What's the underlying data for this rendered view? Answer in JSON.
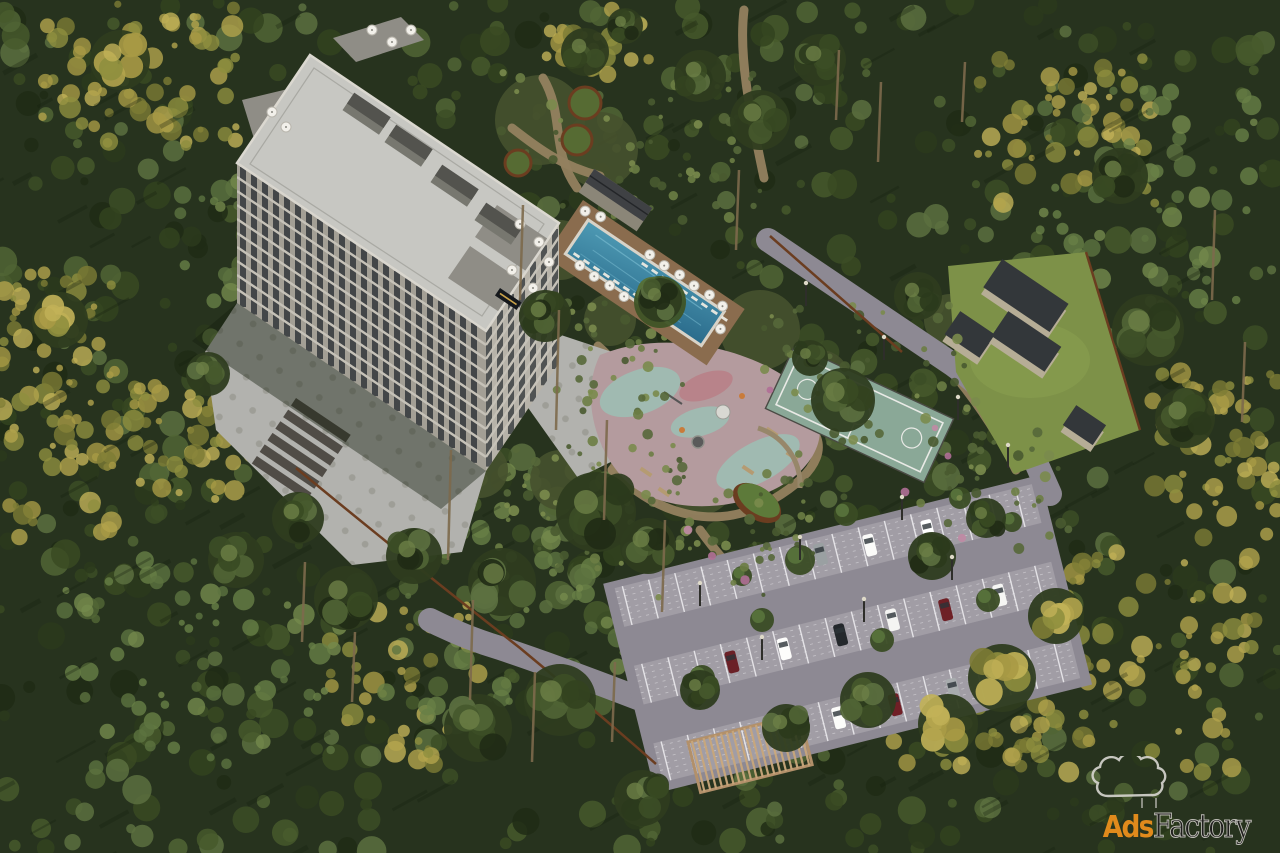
{
  "description": "Aerial 3D render of a high-rise residential complex set in a dense pine forest, with a rooftop-terraced tower, outdoor swimming pool with sun loungers and umbrellas, landscaped gardens with winding paths, a children's playground, a fenced basketball court, a lawn with utility buildings, and a large striped parking lot with cars and a pergola.",
  "watermark": {
    "brand_ads": "Ads",
    "brand_factory": "Factory",
    "icon": "smoke-cloud-icon",
    "color_ads": "#e08a1c",
    "color_factory": "#1f1f1d",
    "color_outline": "#d8d6d0"
  },
  "colors": {
    "forest_base": "#27331e",
    "shadow": "#16200f",
    "plaza": "#b2b2ae",
    "plaza_dot": "#96968f",
    "path": "#93815f",
    "road": "#8d8993",
    "parking_stall": "#a19da5",
    "parking_stripe": "#f0eff2",
    "deck": "#8a6c4e",
    "pool": "#3c86a4",
    "pool_deep": "#2b6c8c",
    "coping": "#d8d3c8",
    "court": "#8aa897",
    "court_line": "#e9eae6",
    "lawn": "#7d9148",
    "rubber_base": "#b49b9e",
    "rubber_teal": "#9cc0b4",
    "rubber_pink": "#b97f86",
    "roof": "#c7c7c2",
    "roof_edge": "#dbd8d0",
    "facade_sw": "#a39f95",
    "facade_se": "#b7b3a9",
    "window": "#363b3e",
    "floor_band": "#c6c2b8",
    "terrace": "#8f8d86",
    "corten": "#6b3d20",
    "box_wall": "#b6ad96",
    "box_top": "#33373a",
    "cabana_roof": "#3f4144",
    "umbrella": "#f2f0ea",
    "green_roof": "#5d7a3a",
    "pergola": "#c9a77b",
    "step": "#504c46",
    "garden_bed": "#46512d",
    "trunk": "#7d6a4c"
  },
  "scene": {
    "forest": {
      "count": 800,
      "palette": [
        "#33431f",
        "#3c4e26",
        "#2b3a1c",
        "#46592c",
        "#516535",
        "#5c7040",
        "#202b15",
        "#394a22"
      ],
      "autumn_palette": [
        "#8f8f3e",
        "#a89a45",
        "#b3a44c",
        "#7d7c35",
        "#c2b258"
      ],
      "light_palette": [
        "#5d7340",
        "#687f46",
        "#74894c"
      ],
      "autumn_regions": [
        [
          40,
          0,
          200,
          150,
          70
        ],
        [
          0,
          270,
          115,
          280,
          80
        ],
        [
          130,
          380,
          130,
          120,
          45
        ],
        [
          975,
          55,
          180,
          150,
          55
        ],
        [
          890,
          545,
          365,
          235,
          150
        ],
        [
          1150,
          365,
          130,
          175,
          55
        ],
        [
          330,
          600,
          150,
          170,
          45
        ],
        [
          545,
          0,
          110,
          75,
          22
        ]
      ],
      "light_regions": [
        [
          380,
          470,
          280,
          250,
          80
        ],
        [
          60,
          560,
          280,
          210,
          60
        ],
        [
          1040,
          90,
          220,
          230,
          55
        ],
        [
          180,
          140,
          220,
          220,
          50
        ]
      ],
      "streaks": 150
    },
    "trunks": [
      [
        448,
        560,
        110
      ],
      [
        520,
        300,
        95
      ],
      [
        556,
        430,
        120
      ],
      [
        604,
        520,
        100
      ],
      [
        662,
        612,
        92
      ],
      [
        470,
        700,
        100
      ],
      [
        532,
        762,
        90
      ],
      [
        612,
        742,
        80
      ],
      [
        836,
        120,
        70
      ],
      [
        878,
        162,
        80
      ],
      [
        962,
        122,
        60
      ],
      [
        1212,
        300,
        90
      ],
      [
        1242,
        422,
        80
      ],
      [
        302,
        642,
        80
      ],
      [
        352,
        702,
        70
      ],
      [
        736,
        250,
        80
      ]
    ],
    "clusters": [
      [
        585,
        52,
        24,
        "g"
      ],
      [
        625,
        26,
        18,
        "g"
      ],
      [
        700,
        76,
        26,
        "g"
      ],
      [
        760,
        120,
        30,
        "g"
      ],
      [
        820,
        60,
        26,
        "g"
      ],
      [
        545,
        316,
        26,
        "g"
      ],
      [
        596,
        512,
        40,
        "g"
      ],
      [
        648,
        546,
        28,
        "g"
      ],
      [
        502,
        582,
        34,
        "g"
      ],
      [
        660,
        300,
        22,
        "g"
      ],
      [
        843,
        400,
        32,
        "g"
      ],
      [
        810,
        358,
        18,
        "g"
      ],
      [
        918,
        296,
        24,
        "g"
      ],
      [
        1148,
        330,
        36,
        "g"
      ],
      [
        1185,
        418,
        30,
        "g"
      ],
      [
        1120,
        176,
        28,
        "g"
      ],
      [
        986,
        518,
        20,
        "g"
      ],
      [
        932,
        556,
        24,
        "g"
      ],
      [
        1056,
        616,
        28,
        "a"
      ],
      [
        1002,
        678,
        34,
        "a"
      ],
      [
        948,
        724,
        30,
        "a"
      ],
      [
        868,
        700,
        28,
        "g"
      ],
      [
        786,
        728,
        24,
        "g"
      ],
      [
        700,
        690,
        20,
        "g"
      ],
      [
        642,
        798,
        28,
        "g"
      ],
      [
        560,
        700,
        36,
        "g"
      ],
      [
        478,
        728,
        34,
        "g"
      ],
      [
        414,
        556,
        28,
        "g"
      ],
      [
        346,
        598,
        32,
        "g"
      ],
      [
        298,
        518,
        26,
        "g"
      ],
      [
        236,
        560,
        28,
        "g"
      ],
      [
        208,
        374,
        22,
        "g"
      ],
      [
        120,
        60,
        30,
        "a"
      ],
      [
        60,
        320,
        28,
        "a"
      ]
    ],
    "garden_beds": [
      [
        540,
        120,
        45
      ],
      [
        600,
        150,
        38
      ],
      [
        560,
        250,
        30
      ],
      [
        520,
        320,
        28
      ],
      [
        610,
        320,
        26
      ],
      [
        760,
        330,
        40
      ],
      [
        820,
        380,
        30
      ],
      [
        700,
        480,
        35
      ],
      [
        560,
        480,
        30
      ],
      [
        480,
        470,
        28
      ],
      [
        950,
        320,
        26
      ],
      [
        900,
        430,
        24
      ]
    ],
    "speckles": [
      [
        500,
        60,
        260,
        160,
        60
      ],
      [
        555,
        295,
        130,
        130,
        40
      ],
      [
        480,
        430,
        210,
        150,
        50
      ],
      [
        755,
        295,
        230,
        210,
        60
      ],
      [
        615,
        468,
        230,
        130,
        45
      ],
      [
        930,
        430,
        140,
        120,
        30
      ]
    ],
    "flowers": [
      [
        770,
        390
      ],
      [
        935,
        428
      ],
      [
        948,
        456
      ],
      [
        905,
        492
      ],
      [
        712,
        556
      ],
      [
        745,
        580
      ],
      [
        688,
        530
      ],
      [
        962,
        538
      ]
    ],
    "paths": [
      "M543,78 C565,115 550,150 577,188",
      "M512,128 C540,150 562,166 600,176",
      "M598,346 C640,382 642,430 612,470",
      "M612,470 C662,520 722,530 772,500",
      "M772,500 C820,472 832,442 802,420",
      "M700,530 C720,558 742,580 762,602",
      "M952,372 Q992,420 1016,470",
      "M744,10 C738,60 752,120 764,178"
    ],
    "roads": [
      "M768,240 L952,364 Q1002,400 1034,458 L1050,494",
      "M648,702 Q560,668 500,648 Q466,638 430,620"
    ],
    "fences": [
      "M770,236 L902,352",
      "M296,468 Q420,570 520,648 Q590,706 656,764",
      "M1086,252 L1140,430"
    ],
    "steps": {
      "x": 296,
      "y": 398,
      "count": 6,
      "w": 66,
      "h": 9,
      "gap": 14
    },
    "planters": [
      [
        585,
        103,
        16
      ],
      [
        577,
        140,
        15
      ],
      [
        518,
        163,
        13
      ]
    ],
    "roof_umbrellas": [
      [
        372,
        30
      ],
      [
        392,
        42
      ],
      [
        411,
        30
      ],
      [
        272,
        112
      ],
      [
        286,
        127
      ],
      [
        520,
        224
      ],
      [
        539,
        242
      ],
      [
        512,
        270
      ],
      [
        533,
        288
      ],
      [
        549,
        262
      ]
    ],
    "roof_boxes": [
      [
        352,
        96
      ],
      [
        394,
        128
      ],
      [
        440,
        168
      ],
      [
        484,
        206
      ]
    ],
    "pool": {
      "umbrellas": [
        [
          86,
          8
        ],
        [
          104,
          9
        ],
        [
          122,
          8
        ],
        [
          140,
          9
        ],
        [
          158,
          8
        ],
        [
          175,
          10
        ],
        [
          24,
          4
        ],
        [
          8,
          8
        ],
        [
          34,
          56
        ],
        [
          52,
          57
        ],
        [
          70,
          56
        ],
        [
          88,
          57
        ],
        [
          186,
          30
        ]
      ],
      "lounger_rows": [
        [
          18,
          84,
          180,
          12
        ],
        [
          48,
          22,
          94,
          12
        ]
      ]
    },
    "playground": {
      "teal_patches": [
        [
          640,
          392,
          42,
          22,
          -20
        ],
        [
          758,
          462,
          46,
          20,
          -28
        ],
        [
          700,
          422,
          30,
          14,
          -15
        ]
      ],
      "pink_patches": [
        [
          706,
          386,
          28,
          13,
          -20
        ]
      ],
      "benches": [
        [
          772,
          432
        ],
        [
          792,
          456
        ],
        [
          748,
          470
        ],
        [
          646,
          472
        ],
        [
          664,
          492
        ]
      ]
    },
    "lawn_structures": [
      [
        1000,
        266,
        80,
        34
      ],
      [
        958,
        318,
        42,
        28
      ],
      [
        1006,
        318,
        64,
        30
      ],
      [
        1074,
        412,
        36,
        24
      ]
    ],
    "parking": {
      "rows_y": [
        -105,
        -25,
        55
      ],
      "row_h": 40,
      "length": 430,
      "cars": [
        [
          258,
          -85,
          "#fbfbf9"
        ],
        [
          318,
          -85,
          "#ffffff"
        ],
        [
          208,
          -88,
          "#9aa0a2"
        ],
        [
          368,
          -86,
          "#1d4763"
        ],
        [
          96,
          -5,
          "#6b2027"
        ],
        [
          150,
          -5,
          "#fdfdfb"
        ],
        [
          208,
          -5,
          "#24282c"
        ],
        [
          262,
          -7,
          "#f4f4f2"
        ],
        [
          316,
          -4,
          "#6e2026"
        ],
        [
          372,
          -5,
          "#f6f6f4"
        ],
        [
          140,
          76,
          "#2a2f33"
        ],
        [
          186,
          75,
          "#fcfcfa"
        ],
        [
          244,
          76,
          "#701f26"
        ],
        [
          304,
          75,
          "#a8acae"
        ],
        [
          356,
          77,
          "#f2f2f0"
        ]
      ],
      "trees": [
        [
          800,
          560,
          15
        ],
        [
          846,
          514,
          12
        ],
        [
          930,
          546,
          13
        ],
        [
          988,
          600,
          12
        ],
        [
          762,
          620,
          12
        ],
        [
          702,
          678,
          13
        ],
        [
          882,
          640,
          12
        ],
        [
          1012,
          522,
          10
        ],
        [
          742,
          576,
          10
        ],
        [
          960,
          498,
          11
        ]
      ]
    },
    "lamps": [
      [
        806,
        306
      ],
      [
        884,
        360
      ],
      [
        958,
        420
      ],
      [
        1008,
        468
      ],
      [
        700,
        606
      ],
      [
        800,
        560
      ],
      [
        902,
        520
      ],
      [
        762,
        660
      ],
      [
        864,
        622
      ],
      [
        952,
        580
      ]
    ]
  }
}
